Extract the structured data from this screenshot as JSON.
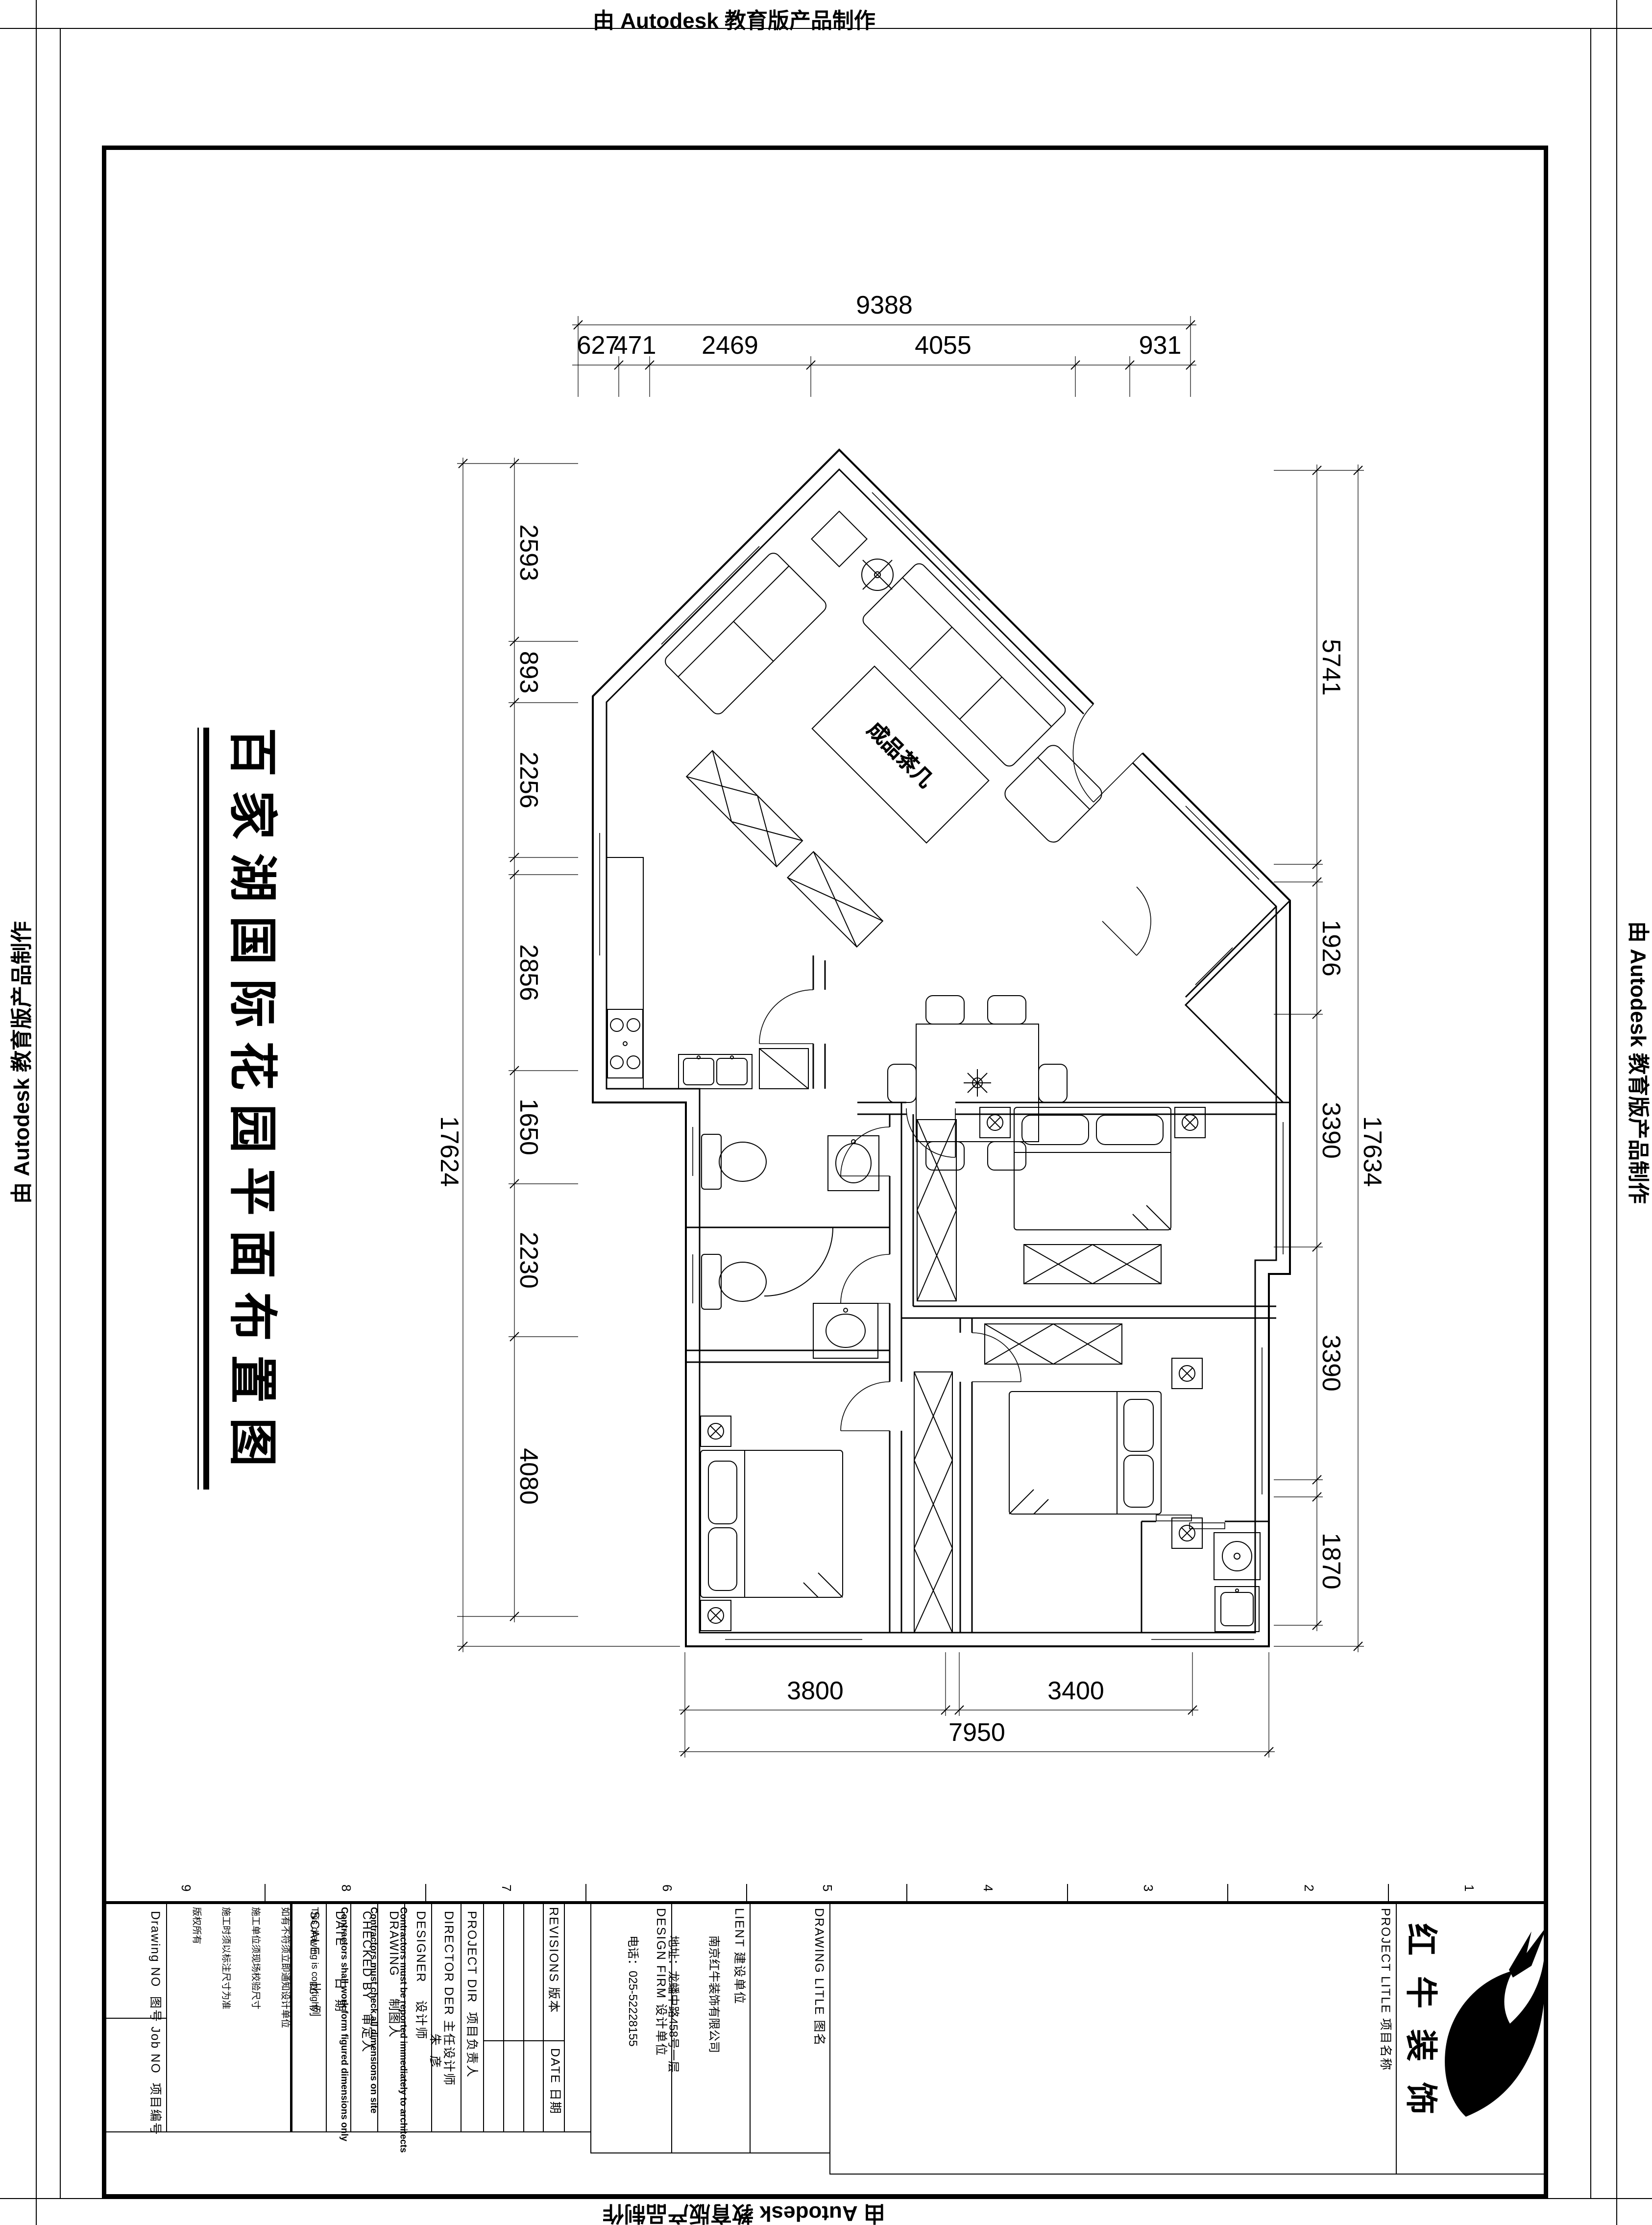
{
  "stamps": {
    "top": "由 Autodesk 教育版产品制作",
    "bottom": "由 Autodesk 教育版产品制作",
    "left": "由 Autodesk 教育版产品制作",
    "right": "由 Autodesk 教育版产品制作"
  },
  "main_title": "百家湖国际花园平面布置图",
  "plan": {
    "coffee_table_label": "成品茶几",
    "dims": {
      "top": {
        "overall": "9388",
        "segments": [
          "627",
          "471",
          "2469",
          "4055",
          "931"
        ]
      },
      "left": {
        "overall": "17624",
        "segments": [
          "2593",
          "893",
          "2256",
          "2856",
          "1650",
          "2230",
          "4080"
        ]
      },
      "right": {
        "overall": "17634",
        "segments": [
          "5741",
          "1926",
          "3390",
          "3390",
          "1870"
        ]
      },
      "bottom": {
        "overall": "7950",
        "segments": [
          "3800",
          "3400"
        ]
      }
    }
  },
  "titleblock": {
    "grid_numbers": [
      "9",
      "8",
      "7",
      "6",
      "5",
      "4",
      "3",
      "2",
      "1"
    ],
    "drawing_no_label": "Drawing NO  图号",
    "job_no_label": "Job NO  项目编号",
    "notes": [
      "版权所有",
      "施工时须以标注尺寸为准",
      "施工单位须现场校验尺寸",
      "如有不符须立即通知设计单位",
      "This drawing is copyright",
      "Contractors shall work form figured dimensions only",
      "Contractors must check all dimensions on site",
      "Contractors must be reported immediately to architects"
    ],
    "scale_label": "SCALE      比  例",
    "date_label": "DATE       日  期",
    "checked_by_label": "CHECKED BY   审定人",
    "drawing_label": "DRAWING     制图人",
    "designer_label": "DESIGNER    设计师",
    "director_label": "DIRECTOR DER 主任设计师",
    "director_value": "朱  彦",
    "project_dir_label": "PROJECT DIR  项目负责人",
    "revisions_label": "REVISIONS 版本",
    "revisions_date_label": "DATE 日期",
    "design_firm_label": "DESIGN FIRM 设计单位",
    "company": "南京红牛装饰有限公司",
    "address": "地址：龙蟠中路458号一层",
    "phone": "电话：025-52228155",
    "client_label": "LIENT 建设单位",
    "drawing_title_label": "DRAWING LITLE 图名",
    "project_title_label": "PROJECT LITLE 项目名称",
    "logo_text": "红牛装饰"
  }
}
